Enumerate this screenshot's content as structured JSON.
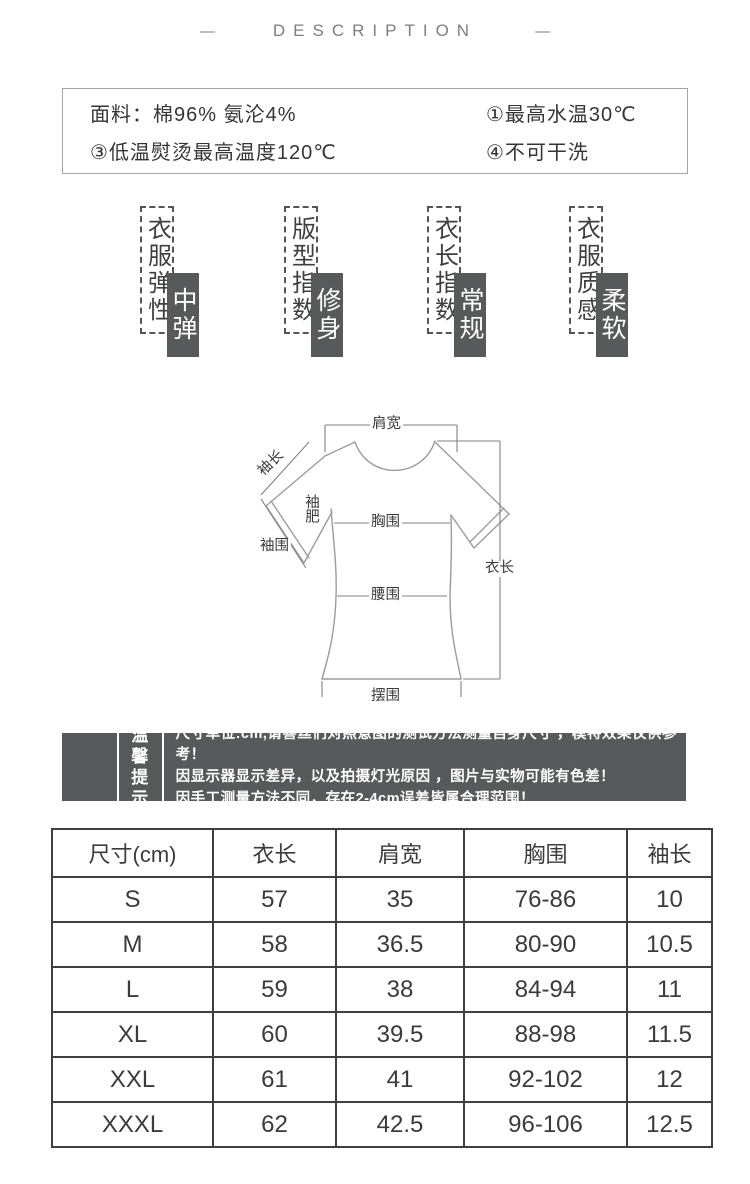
{
  "page": {
    "title": "DESCRIPTION",
    "dash": "—"
  },
  "care_box": {
    "items": [
      "面料：棉96%  氨沦4%",
      "①最高水温30℃",
      "③低温熨烫最高温度120℃",
      "④不可干洗"
    ]
  },
  "attributes": [
    {
      "label": "衣服弹性",
      "value": "中弹"
    },
    {
      "label": "版型指数",
      "value": "修身"
    },
    {
      "label": "衣长指数",
      "value": "常规"
    },
    {
      "label": "衣服质感",
      "value": "柔软"
    }
  ],
  "diagram": {
    "labels": {
      "shoulder": "肩宽",
      "sleeve_length": "袖长",
      "sleeve_width": "袖肥",
      "chest": "胸围",
      "cuff": "袖围",
      "garment_length": "衣长",
      "waist": "腰围",
      "hem": "摆围"
    }
  },
  "tips": {
    "badge": [
      "温馨",
      "提示"
    ],
    "lines": [
      "尺寸单位:cm,请喜丝们对照意图的测试方法测量自身尺寸 ，模特效果仅供参考！",
      "因显示器显示差异，以及拍摄灯光原因 ，图片与实物可能有色差！",
      "因手工测量方法不同，存在2-4cm误差皆属合理范围！"
    ]
  },
  "size_table": {
    "headers": [
      "尺寸(cm)",
      "衣长",
      "肩宽",
      "胸围",
      "袖长"
    ],
    "rows": [
      [
        "S",
        "57",
        "35",
        "76-86",
        "10"
      ],
      [
        "M",
        "58",
        "36.5",
        "80-90",
        "10.5"
      ],
      [
        "L",
        "59",
        "38",
        "84-94",
        "11"
      ],
      [
        "XL",
        "60",
        "39.5",
        "88-98",
        "11.5"
      ],
      [
        "XXL",
        "61",
        "41",
        "92-102",
        "12"
      ],
      [
        "XXXL",
        "62",
        "42.5",
        "96-106",
        "12.5"
      ]
    ]
  },
  "colors": {
    "accent_gray": "#58595b",
    "line_gray": "#9a9a9a",
    "text_dark": "#3b3b3b"
  }
}
